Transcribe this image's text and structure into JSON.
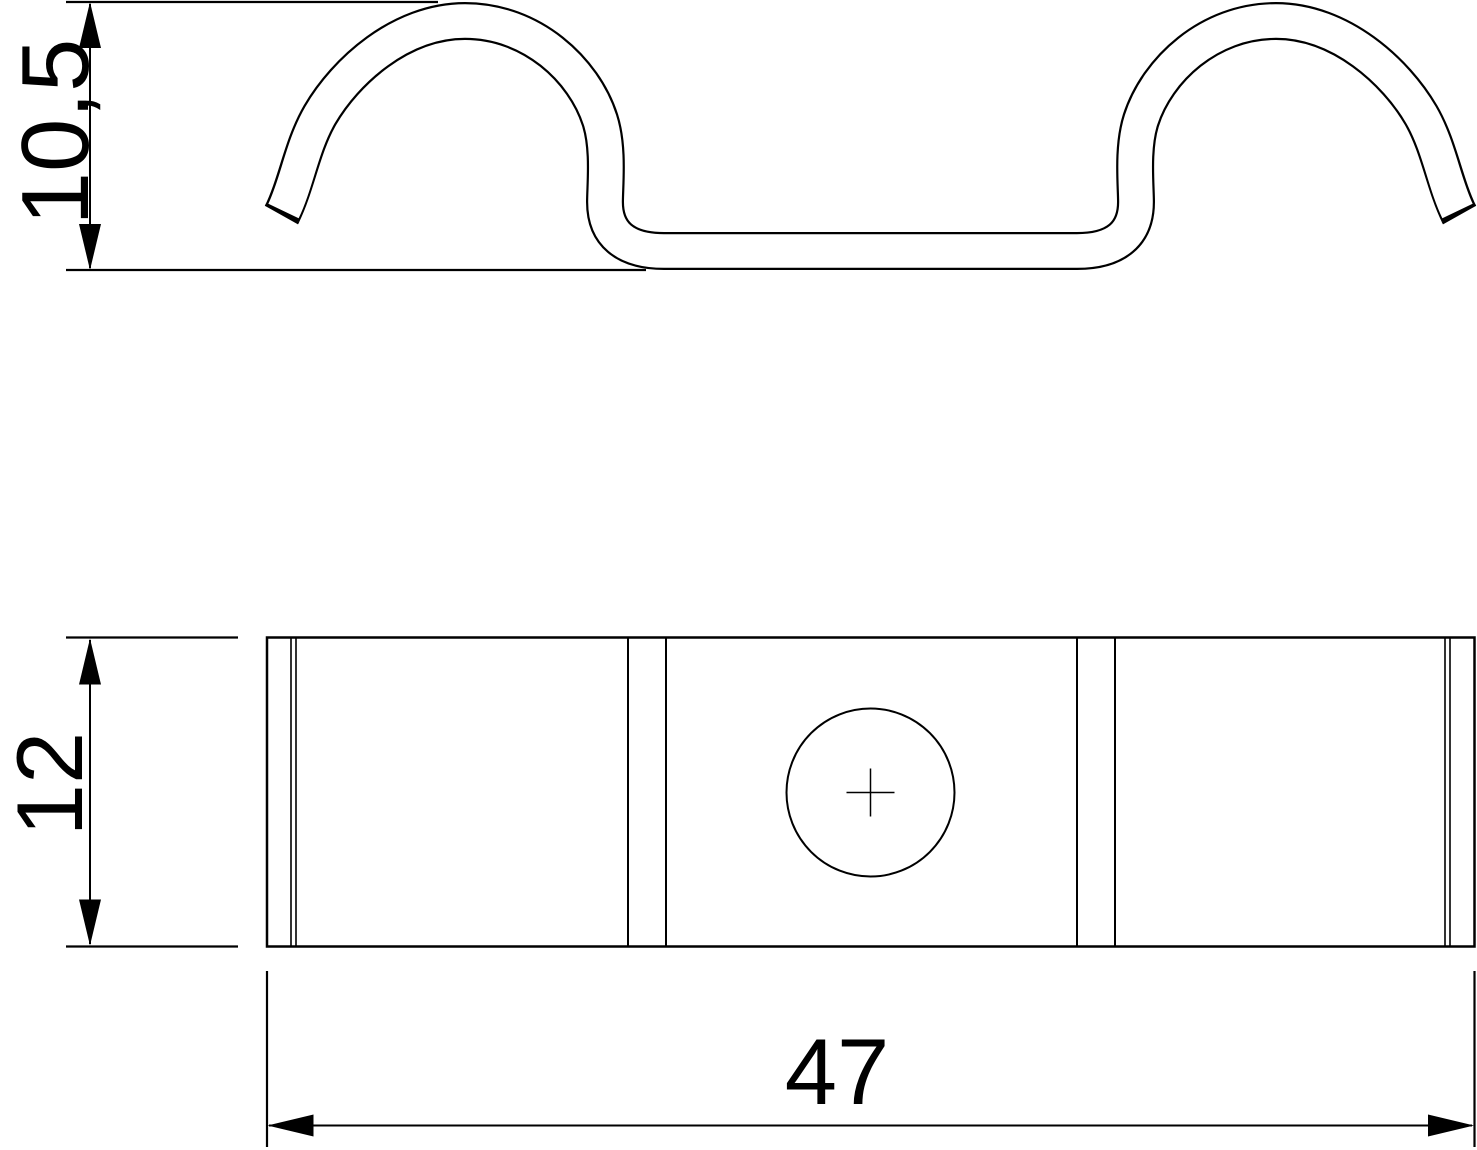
{
  "drawing": {
    "background": "#ffffff",
    "line_color": "#000000",
    "views": {
      "profile": {
        "name": "spring-clip-side-profile",
        "dimension_height": {
          "label": "10,5",
          "orientation": "vertical"
        }
      },
      "plan": {
        "name": "clip-plan-view",
        "hole": {
          "shape": "circle",
          "marker": "center-cross"
        },
        "dimension_depth": {
          "label": "12",
          "orientation": "vertical"
        },
        "dimension_length": {
          "label": "47",
          "orientation": "horizontal"
        }
      }
    }
  }
}
